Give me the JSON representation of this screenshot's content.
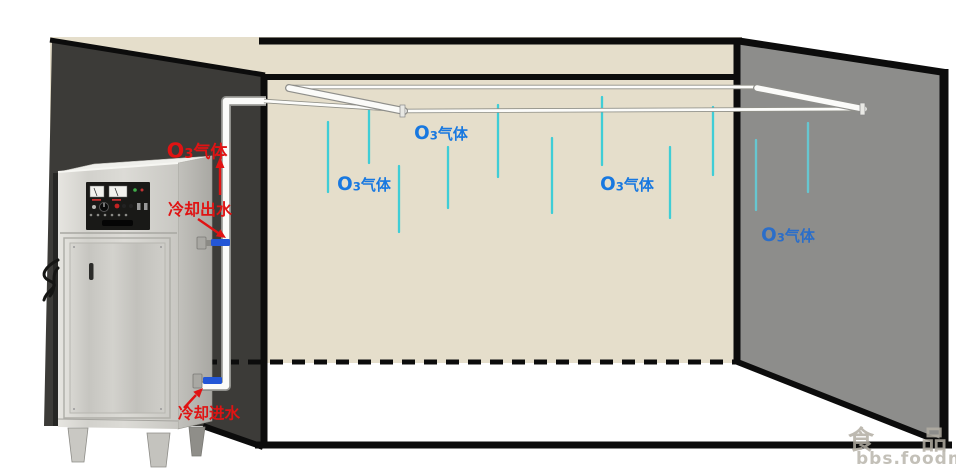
{
  "labels": {
    "o3_gas_machine": "O3气体",
    "cooling_out": "冷却出水",
    "cooling_in": "冷却进水",
    "o3_gas_room": [
      "O3气体",
      "O3气体",
      "O3气体",
      "O3气体"
    ]
  },
  "watermark": {
    "line1": "食 品 论",
    "line2": "bbs.foodma"
  },
  "colors": {
    "label_blue": "#1878e0",
    "label_blue_on_wall": "#2b6ec9",
    "label_red": "#e01313",
    "gas_drop_cyan": "#3fcdd6",
    "valve_blue": "#2356d6",
    "back_wall_beige": "#e5decb",
    "left_wall_dark": "#3c3b38",
    "right_wall_gray": "#8d8d8b",
    "outline_black": "#0c0c0c",
    "pipe_white": "#fbfbf9"
  }
}
